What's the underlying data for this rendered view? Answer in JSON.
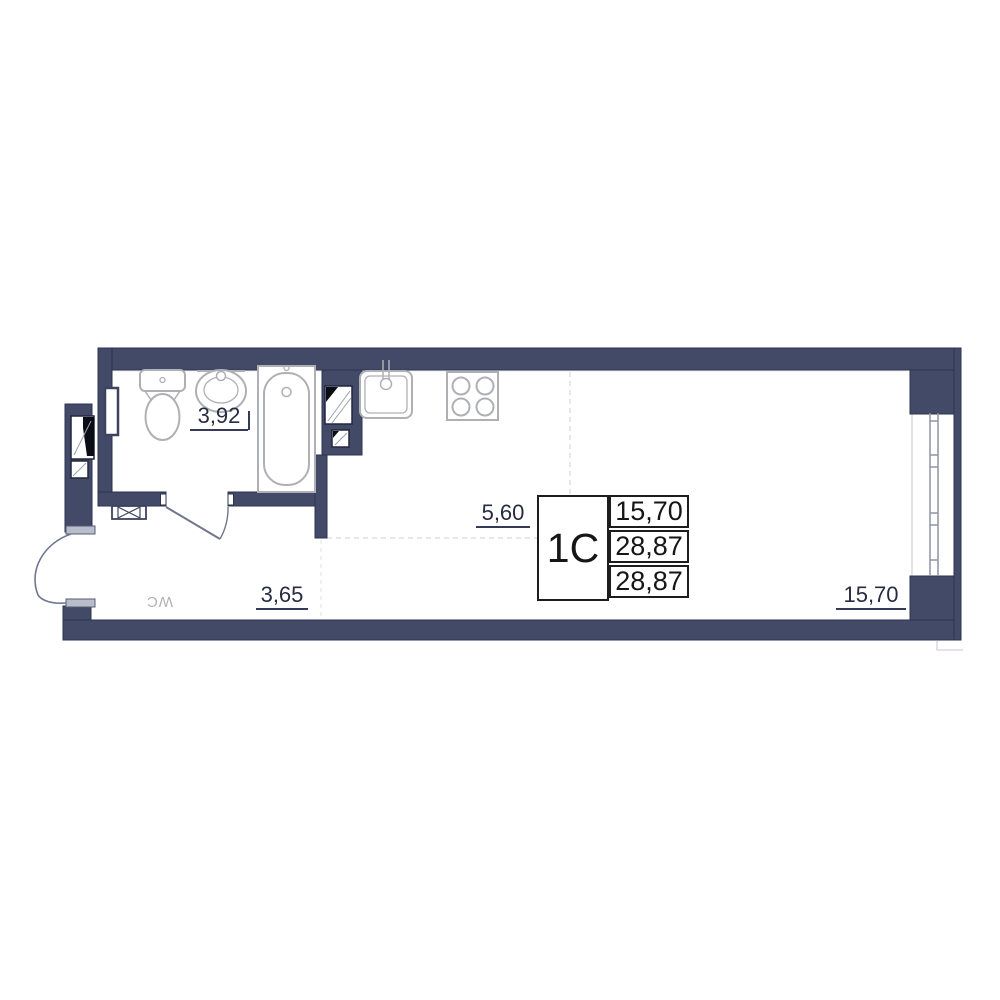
{
  "unit": {
    "code": "1C",
    "area_rows": [
      "15,70",
      "28,87",
      "28,87"
    ]
  },
  "dimensions": {
    "bathroom_width": "3,92",
    "living_width": "5,60",
    "hall_width": "3,65",
    "living_length": "15,70"
  },
  "labels": {
    "wc": "WC"
  },
  "colors": {
    "wall": "#434a68",
    "wall_outline": "#2e344f",
    "fixture_stroke": "#aeb0b6",
    "dimension_text": "#272c42",
    "info_text": "#161616"
  },
  "icons": {
    "toilet": "toilet-plan-icon",
    "bathroom_sink": "sink-plan-icon",
    "bathtub": "bathtub-plan-icon",
    "kitchen_sink": "kitchen-sink-plan-icon",
    "stove": "stove-4-burner-icon",
    "window": "window-plan-icon",
    "entrance_door": "door-swing-icon",
    "bathroom_door": "door-swing-icon",
    "vent_grate": "vent-grate-icon",
    "duct_shaft": "duct-shaft-icon",
    "radiator": "radiator-icon"
  }
}
